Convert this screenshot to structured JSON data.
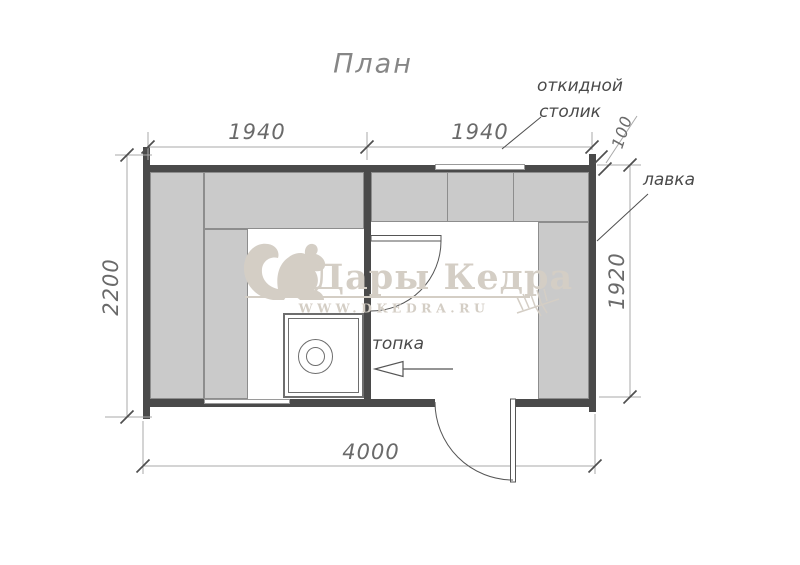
{
  "title": "План",
  "labels": {
    "folding_table_line1": "откидной",
    "folding_table_line2": "столик",
    "bench": "лавка",
    "furnace": "топка"
  },
  "dimensions": {
    "top_left": "1940",
    "top_right": "1940",
    "overhang": "100",
    "left_total": "2200",
    "right_room": "1920",
    "bottom_total": "4000"
  },
  "watermark": {
    "brand": "Дары Кедра",
    "website": "WWW.DKEDRA.RU"
  },
  "colors": {
    "wall": "#4a4a4a",
    "bench_fill": "#cacaca",
    "bench_border": "#8d8d8d",
    "dimension_line": "#a9a9a9",
    "dimension_text": "#6a6a6a",
    "label_text": "#4a4a4a",
    "watermark": "#d4cec5",
    "title_text": "#868686"
  },
  "icons": {
    "squirrel": "squirrel-icon",
    "branch": "fir-branch-icon",
    "tick": "dim-tick-icon",
    "furnace_arrow": "furnace-arrow-icon"
  }
}
